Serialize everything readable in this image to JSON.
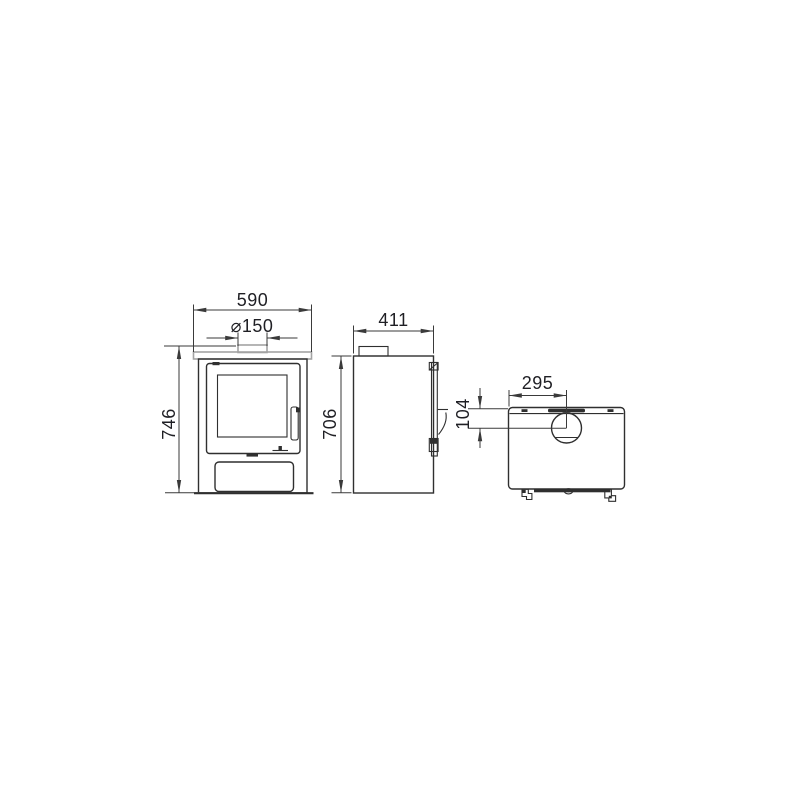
{
  "drawing": {
    "type": "technical-orthographic-drawing",
    "subject": "wood-burning stove",
    "views": [
      "front",
      "side",
      "top"
    ],
    "dimensions": {
      "front_width": "590",
      "flue_diameter": "⌀150",
      "front_height": "746",
      "side_depth": "411",
      "side_height": "706",
      "flue_center_from_side": "295",
      "flue_center_from_rear": "104"
    },
    "colors": {
      "background": "#ffffff",
      "ink": "#2f2f2f",
      "dim_line": "#3a3a3a",
      "text": "#1f1f24",
      "steel_gray": "#a3a3a3"
    }
  }
}
